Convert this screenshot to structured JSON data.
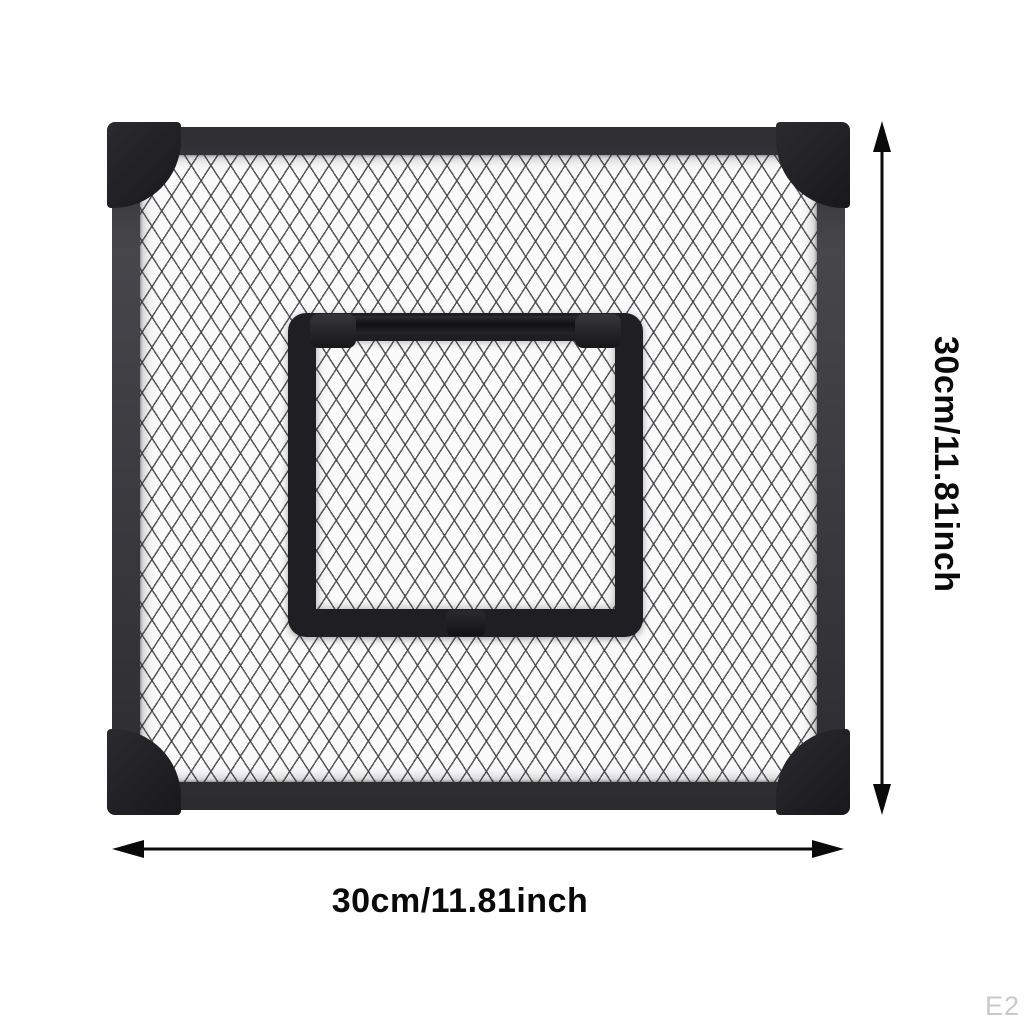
{
  "image": {
    "background_color": "#ffffff",
    "watermark": "E2"
  },
  "product": {
    "outer_frame_color": "#3a3a3f",
    "corner_cap_color": "#202024",
    "flap_frame_color": "#1f1f23",
    "mesh_background_color": "#fbfbfb",
    "mesh_line_color": "#3e3e42"
  },
  "dimensions": {
    "annotation_color": "#0a0a0a",
    "height": {
      "label": "30cm/11.81inch"
    },
    "width": {
      "label": "30cm/11.81inch"
    }
  }
}
